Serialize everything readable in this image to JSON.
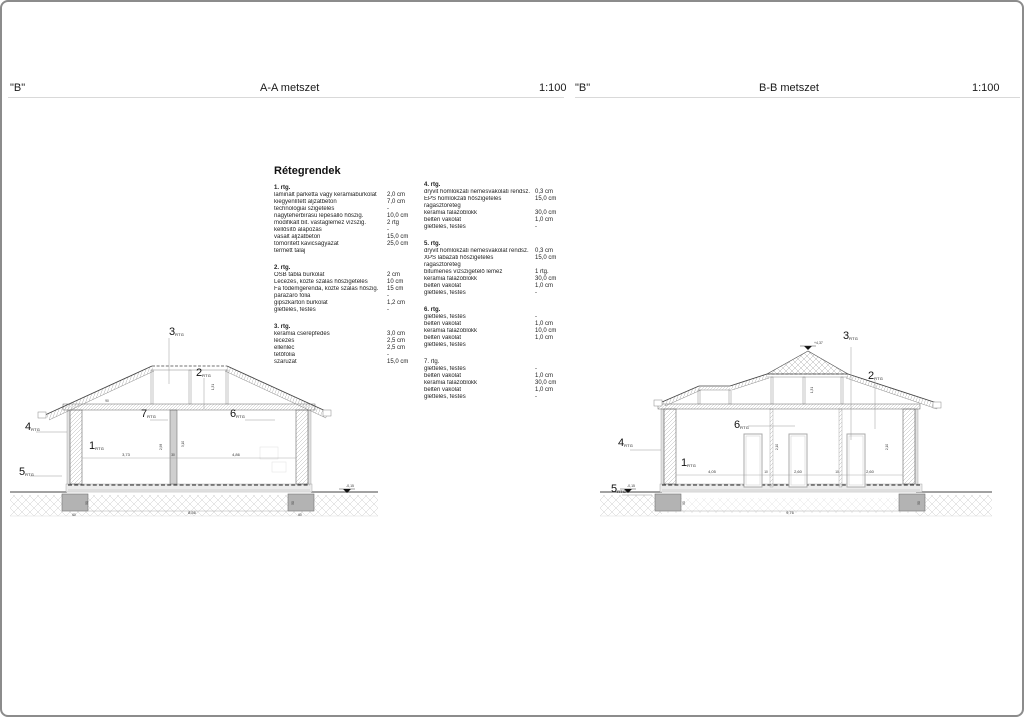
{
  "header": {
    "aa_quote": "\"B\"",
    "aa_title": "A-A metszet",
    "aa_scale": "1:100",
    "bb_quote": "\"B\"",
    "bb_title": "B-B metszet",
    "bb_scale": "1:100"
  },
  "legend": {
    "title": "Rétegrendek",
    "groups": [
      {
        "id": "1. rtg.",
        "rows": [
          {
            "n": "laminált parketta vagy kerámiaburkolat",
            "v": "2,0 cm"
          },
          {
            "n": "kiegyenlített aljzatbeton",
            "v": "7,0 cm"
          },
          {
            "n": "technológiai szigetelés",
            "v": "-"
          },
          {
            "n": "nagyteherbírású lépésálló hőszig.",
            "v": "10,0 cm"
          },
          {
            "n": "modifikált bit. vastaglemez vízszig.",
            "v": "2 rtg"
          },
          {
            "n": "kellősítő alapozás",
            "v": "-"
          },
          {
            "n": "vasalt aljzatbeton",
            "v": "15,0 cm"
          },
          {
            "n": "tömörített kavicságyazat",
            "v": "25,0 cm"
          },
          {
            "n": "termett talaj",
            "v": ""
          }
        ]
      },
      {
        "id": "2. rtg.",
        "rows": [
          {
            "n": "OSB tábla burkolat",
            "v": "2 cm"
          },
          {
            "n": "Lécezés, közte szálas hőszigetelés",
            "v": "10 cm"
          },
          {
            "n": "Fa födémgerenda, közte szálas hőszig.",
            "v": "15 cm"
          },
          {
            "n": "párazáró fólia",
            "v": "-"
          },
          {
            "n": "gipszkarton burkolat",
            "v": "1,2 cm"
          },
          {
            "n": "glettelés, festés",
            "v": "-"
          }
        ]
      },
      {
        "id": "3. rtg.",
        "rows": [
          {
            "n": "kerámia cserépfedés",
            "v": "3,0 cm"
          },
          {
            "n": "lécezés",
            "v": "2,5 cm"
          },
          {
            "n": "ellenléc",
            "v": "2,5 cm"
          },
          {
            "n": "tetőfólia",
            "v": "-"
          },
          {
            "n": "szaruzat",
            "v": "15,0 cm"
          }
        ]
      },
      {
        "id": "4. rtg.",
        "rows": [
          {
            "n": "dryvit homlokzati nemesvakolati rendsz.",
            "v": "0,3 cm"
          },
          {
            "n": "EPS homlokzati hőszigetelés",
            "v": "15,0 cm"
          },
          {
            "n": "ragasztóréteg",
            "v": ""
          },
          {
            "n": "kerámia falazóblokk",
            "v": "30,0 cm"
          },
          {
            "n": "beltéri vakolat",
            "v": "1,0 cm"
          },
          {
            "n": "glettelés, festés",
            "v": "-"
          }
        ]
      },
      {
        "id": "5. rtg.",
        "rows": [
          {
            "n": "dryvit homlokzati nemesvakolat rendsz.",
            "v": "0,3 cm"
          },
          {
            "n": "XPS lábazati hőszigetelés",
            "v": "15,0 cm"
          },
          {
            "n": "ragasztóréteg",
            "v": ""
          },
          {
            "n": "bitumenes vízszigetelő lemez",
            "v": "1 rtg."
          },
          {
            "n": "kerámia falazóblokk",
            "v": "30,0 cm"
          },
          {
            "n": "beltéri vakolat",
            "v": "1,0 cm"
          },
          {
            "n": "glettelés, festés",
            "v": "-"
          }
        ]
      },
      {
        "id": "6. rtg.",
        "rows": [
          {
            "n": "glettelés, festés",
            "v": "-"
          },
          {
            "n": "beltéri vakolat",
            "v": "1,0 cm"
          },
          {
            "n": "kerámia falazóblokk",
            "v": "10,0 cm"
          },
          {
            "n": "beltéri vakolat",
            "v": "1,0 cm"
          },
          {
            "n": "glettelés, festés",
            "v": ""
          }
        ]
      },
      {
        "id": "7. rtg.",
        "rows": [
          {
            "n": "",
            "v": ""
          },
          {
            "n": "glettelés, festés",
            "v": "-"
          },
          {
            "n": "beltéri vakolat",
            "v": "1,0 cm"
          },
          {
            "n": "kerámia falazóblokk",
            "v": "30,0 cm"
          },
          {
            "n": "beltéri vakolat",
            "v": "1,0 cm"
          },
          {
            "n": "glettelés, festés",
            "v": "-"
          }
        ]
      }
    ]
  },
  "sections": {
    "marker_sub": "RTG",
    "aa": {
      "markers": [
        {
          "n": "1"
        },
        {
          "n": "2"
        },
        {
          "n": "3"
        },
        {
          "n": "4"
        },
        {
          "n": "5"
        },
        {
          "n": "6"
        },
        {
          "n": "7"
        }
      ],
      "dims": {
        "room_left": "3,73",
        "wall": "30",
        "room_right": "4,86",
        "height_left": "2,98",
        "height_right": "3,10",
        "attic_height": "1,31",
        "ceiling_spacing": "90",
        "total": "8,56",
        "foundation_width": "60",
        "foundation_depth": "50",
        "level_ground": "-0,15"
      }
    },
    "bb": {
      "markers": [
        {
          "n": "1"
        },
        {
          "n": "2"
        },
        {
          "n": "3"
        },
        {
          "n": "4"
        },
        {
          "n": "5"
        },
        {
          "n": "6"
        }
      ],
      "dims": {
        "seg1": "4,05",
        "jamb1": "10",
        "seg2": "2,60",
        "jamb2": "10",
        "seg3": "2,60",
        "door_height": "2,10",
        "attic_height": "1,31",
        "total": "9,76",
        "foundation_depth": "50",
        "level_ground": "-0,15",
        "level_ridge": "+4,37"
      }
    }
  }
}
